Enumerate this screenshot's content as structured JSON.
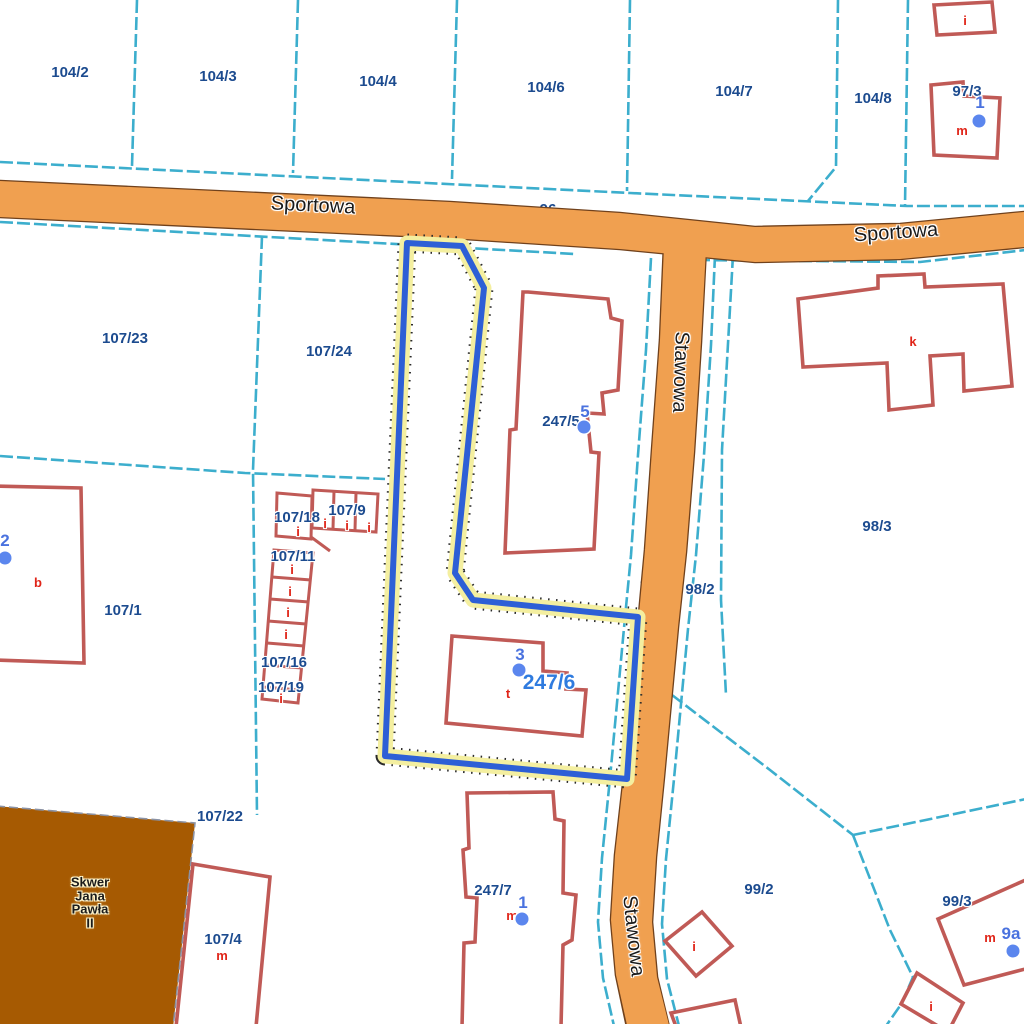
{
  "colors": {
    "parcel_line": "#3CAECD",
    "parcel_label": "#1C4B8F",
    "building": "#C05A56",
    "building_letter": "#E02519",
    "address": "#4A72DF",
    "address_dot": "#5B86EE",
    "road_fill": "#F0A050",
    "road_border": "#70411C",
    "road_text": "#1A1A1A",
    "selected_core": "#2D5FD6",
    "selected_halo": "#F4EFA0",
    "selected_label": "#2F7BDF",
    "park_fill": "#A65A02"
  },
  "selected_parcel": {
    "label": "247/6",
    "x": 549,
    "y": 683
  },
  "streets": [
    {
      "name": "Sportowa",
      "x": 313,
      "y": 206,
      "rotation": 2.8
    },
    {
      "name": "Sportowa",
      "x": 896,
      "y": 233,
      "rotation": -4
    },
    {
      "name": "Stawowa",
      "x": 680,
      "y": 372,
      "rotation": 92
    },
    {
      "name": "Stawowa",
      "x": 633,
      "y": 936,
      "rotation": 84
    }
  ],
  "parcel_labels": [
    {
      "text": "104/2",
      "x": 70,
      "y": 73
    },
    {
      "text": "104/3",
      "x": 218,
      "y": 77
    },
    {
      "text": "104/4",
      "x": 378,
      "y": 82
    },
    {
      "text": "104/6",
      "x": 546,
      "y": 88
    },
    {
      "text": "104/7",
      "x": 734,
      "y": 92
    },
    {
      "text": "104/8",
      "x": 873,
      "y": 99
    },
    {
      "text": "97/3",
      "x": 967,
      "y": 92
    },
    {
      "text": "107/23",
      "x": 125,
      "y": 339
    },
    {
      "text": "107/24",
      "x": 329,
      "y": 352
    },
    {
      "text": "98/3",
      "x": 877,
      "y": 527
    },
    {
      "text": "98/2",
      "x": 700,
      "y": 590
    },
    {
      "text": "107/18",
      "x": 297,
      "y": 518
    },
    {
      "text": "107/9",
      "x": 347,
      "y": 511
    },
    {
      "text": "107/11",
      "x": 293,
      "y": 557
    },
    {
      "text": "107/16",
      "x": 284,
      "y": 663
    },
    {
      "text": "107/19",
      "x": 281,
      "y": 688
    },
    {
      "text": "107/1",
      "x": 123,
      "y": 611
    },
    {
      "text": "107/22",
      "x": 220,
      "y": 817
    },
    {
      "text": "107/4",
      "x": 223,
      "y": 940
    },
    {
      "text": "247/5",
      "x": 561,
      "y": 422
    },
    {
      "text": "247/7",
      "x": 493,
      "y": 891
    },
    {
      "text": "99/2",
      "x": 759,
      "y": 890
    },
    {
      "text": "99/3",
      "x": 957,
      "y": 902
    }
  ],
  "partial_parcel_labels": [
    {
      "text": "96",
      "x": 548,
      "y": 214
    },
    {
      "text": "10",
      "x": 648,
      "y": 590
    }
  ],
  "building_labels": [
    {
      "text": "i",
      "x": 965,
      "y": 21
    },
    {
      "text": "m",
      "x": 962,
      "y": 131
    },
    {
      "text": "k",
      "x": 913,
      "y": 342
    },
    {
      "text": "b",
      "x": 38,
      "y": 583
    },
    {
      "text": "i",
      "x": 298,
      "y": 532
    },
    {
      "text": "i",
      "x": 325,
      "y": 524
    },
    {
      "text": "i",
      "x": 347,
      "y": 526
    },
    {
      "text": "i",
      "x": 369,
      "y": 528
    },
    {
      "text": "i",
      "x": 292,
      "y": 570
    },
    {
      "text": "i",
      "x": 290,
      "y": 592
    },
    {
      "text": "i",
      "x": 288,
      "y": 613
    },
    {
      "text": "i",
      "x": 286,
      "y": 635
    },
    {
      "text": "i",
      "x": 281,
      "y": 699
    },
    {
      "text": "t",
      "x": 508,
      "y": 694
    },
    {
      "text": "m",
      "x": 222,
      "y": 956
    },
    {
      "text": "m",
      "x": 512,
      "y": 916
    },
    {
      "text": "m",
      "x": 990,
      "y": 938
    },
    {
      "text": "i",
      "x": 694,
      "y": 947
    },
    {
      "text": "i",
      "x": 931,
      "y": 1007
    }
  ],
  "address_points": [
    {
      "text": "1",
      "x": 980,
      "y": 103,
      "dx": 979,
      "dy": 121
    },
    {
      "text": "5",
      "x": 585,
      "y": 412,
      "dx": 584,
      "dy": 427
    },
    {
      "text": "3",
      "x": 520,
      "y": 655,
      "dx": 519,
      "dy": 670
    },
    {
      "text": "2",
      "x": 5,
      "y": 541,
      "dx": 5,
      "dy": 558
    },
    {
      "text": "1",
      "x": 523,
      "y": 903,
      "dx": 522,
      "dy": 919
    },
    {
      "text": "9a",
      "x": 1011,
      "y": 934,
      "dx": 1013,
      "dy": 951
    }
  ],
  "park": {
    "name": "Skwer Jana Pawła II",
    "label_lines": "Skwer\nJana\nPawła\nII",
    "x": 90,
    "y": 903
  }
}
